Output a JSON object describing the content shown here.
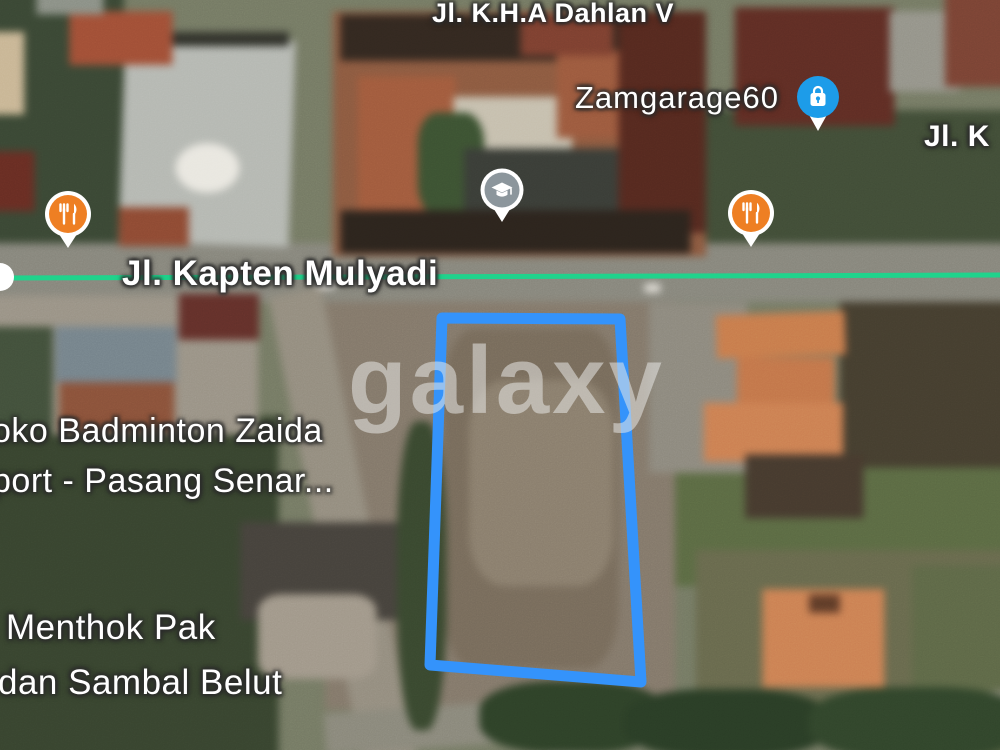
{
  "map": {
    "watermark_text": "galaxy",
    "streets": {
      "dahlan_v": {
        "label": "Jl. K.H.A Dahlan V"
      },
      "kapten_mulyadi": {
        "label": "Jl. Kapten Mulyadi"
      },
      "jl_k_cropped": {
        "label": "Jl. K"
      }
    },
    "pois": {
      "zamgarage": {
        "label": "Zamgarage60"
      },
      "badminton_store": {
        "line1": "oko Badminton Zaida",
        "line2": "port - Pasang Senar..."
      },
      "menthok_warung": {
        "line1": "Menthok Pak",
        "line2": "dan Sambal Belut"
      }
    },
    "pins": {
      "restaurant_west": {
        "type": "restaurant",
        "color": "#EE7F23"
      },
      "restaurant_east": {
        "type": "restaurant",
        "color": "#EE7F23"
      },
      "school": {
        "type": "school",
        "color": "#8C969C"
      },
      "shopping_bag": {
        "type": "shopping",
        "color": "#1D9CE9"
      }
    },
    "overlays": {
      "parcel_outline_color": "#3493FB",
      "transit_line_color": "#20D38C"
    }
  }
}
